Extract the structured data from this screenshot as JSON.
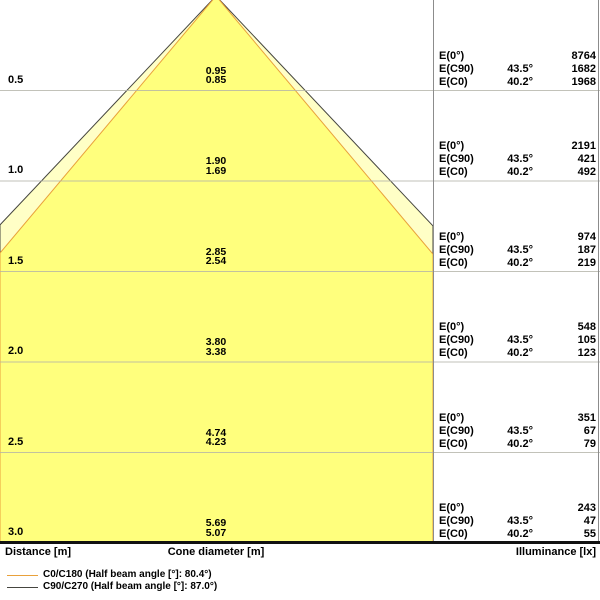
{
  "chart_data": {
    "type": "area",
    "subtype": "luminaire-light-cone-diagram",
    "distance_axis_label": "Distance [m]",
    "cone_axis_label": "Cone diameter [m]",
    "illuminance_axis_label": "Illuminance [lx]",
    "distances_m": [
      0.5,
      1.0,
      1.5,
      2.0,
      2.5,
      3.0
    ],
    "e0": {
      "label": "E(0°)",
      "illuminance_lx": [
        8764,
        2191,
        974,
        548,
        351,
        243
      ]
    },
    "series": [
      {
        "name": "C90/C270",
        "legend_label": "C90/C270 (Half beam angle [°]: 87.0°)",
        "half_beam_angle_deg": 87.0,
        "e_label": "E(C90)",
        "angle_label": "43.5°",
        "line_color": "#45453f",
        "fill_color": "#ffffc6",
        "cone_diameters_m": [
          0.95,
          1.9,
          2.85,
          3.8,
          4.74,
          5.69
        ],
        "illuminance_lx": [
          1682,
          421,
          187,
          105,
          67,
          47
        ]
      },
      {
        "name": "C0/C180",
        "legend_label": "C0/C180 (Half beam angle [°]: 80.4°)",
        "half_beam_angle_deg": 80.4,
        "e_label": "E(C0)",
        "angle_label": "40.2°",
        "line_color": "#e9a13b",
        "fill_color": "#ffff7d",
        "cone_diameters_m": [
          0.85,
          1.69,
          2.54,
          3.38,
          4.23,
          5.07
        ],
        "illuminance_lx": [
          1968,
          492,
          219,
          123,
          79,
          55
        ]
      }
    ],
    "colors": {
      "gridline": "#b4b4a8",
      "table_border": "#8c8c8c",
      "bottom_axis": "#111111",
      "background": "#ffffff"
    },
    "layout": {
      "apex_x": 216,
      "apex_y": -4,
      "plot_right": 433,
      "bottom_y": 543,
      "px_per_m_x": 180,
      "px_per_m_y": 181,
      "gridlines_on": true,
      "legend_position": "bottom-left"
    }
  }
}
